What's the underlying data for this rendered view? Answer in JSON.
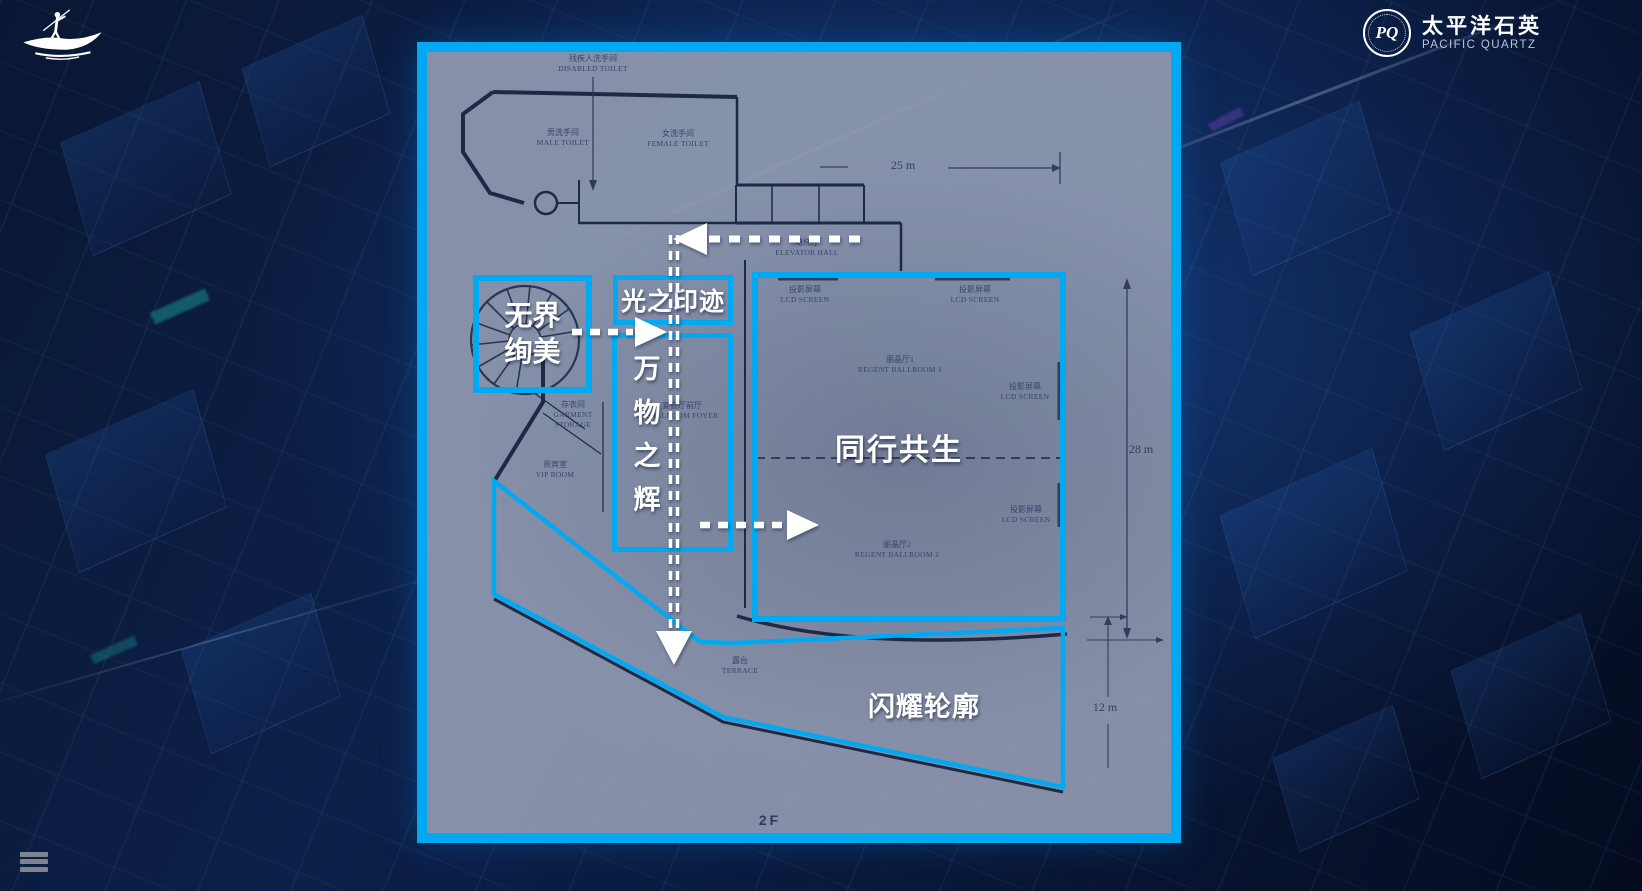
{
  "brand": {
    "emblem_text": "PQ",
    "name_cn": "太平洋石英",
    "name_en": "PACIFIC QUARTZ"
  },
  "icons": {
    "top_left_logo": "boat-figure",
    "menu": "hamburger"
  },
  "floor_label": "2F",
  "zones": {
    "wujie_xuanmei": "无界绚美",
    "guang_zhi_yinji": "光之印迹",
    "wanwu_zhi_hui": "万物之辉",
    "tongxing_gongsheng": "同行共生",
    "shanyao_lunkuo": "闪耀轮廓"
  },
  "plan_labels": {
    "disabled_toilet": {
      "cn": "残疾人洗手间",
      "en": "DISABLED TOILET"
    },
    "male_toilet": {
      "cn": "男洗手间",
      "en": "MALE TOILET"
    },
    "female_toilet": {
      "cn": "女洗手间",
      "en": "FEMALE TOILET"
    },
    "elevator_hall": {
      "cn": "电梯厅",
      "en": "ELEVATOR HALL"
    },
    "lcd_screen": {
      "cn": "投影屏幕",
      "en": "LCD SCREEN"
    },
    "regent_ballroom_1": {
      "cn": "丽晶厅1",
      "en": "REGENT BALLROOM 1"
    },
    "regent_ballroom_2": {
      "cn": "丽晶厅2",
      "en": "REGENT BALLROOM 2"
    },
    "ballroom_foyer": {
      "cn": "宴会厅前厅",
      "en": "BALLROOM FOYER"
    },
    "garment_storage": {
      "cn": "存衣间",
      "en": "GARMENT STORAGE"
    },
    "vip_room": {
      "cn": "贵宾室",
      "en": "VIP ROOM"
    },
    "terrace": {
      "cn": "露台",
      "en": "TERRACE"
    }
  },
  "dimensions": {
    "width_top": "25 m",
    "height_right": "28 m",
    "height_bottom": "12 m"
  },
  "colors": {
    "accent_cyan": "#00a9f2",
    "background_navy": "#0a1734",
    "plan_fill": "#949caf",
    "plan_line": "#1d2946"
  }
}
